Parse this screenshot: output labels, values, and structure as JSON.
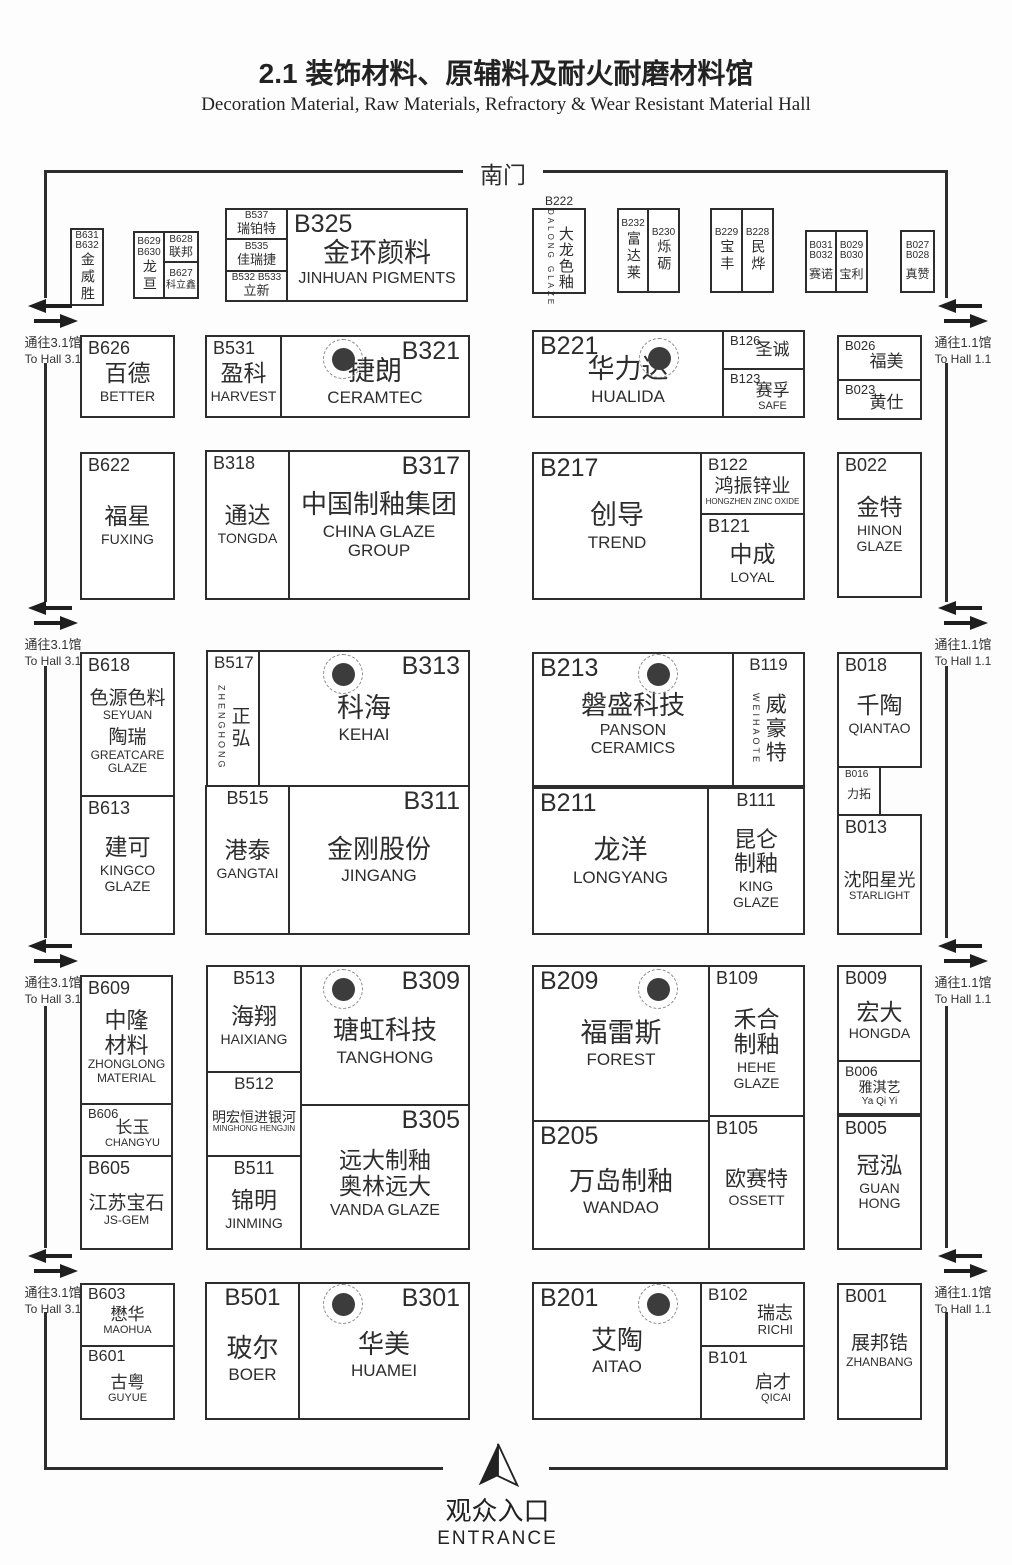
{
  "header": {
    "title_cn": "2.1 装饰材料、原辅料及耐火耐磨材料馆",
    "title_en": "Decoration Material, Raw Materials, Refractory & Wear Resistant Material Hall"
  },
  "gates": {
    "south": "南门"
  },
  "entrance": {
    "cn": "观众入口",
    "en": "ENTRANCE"
  },
  "passages": {
    "left_cn": "通往3.1馆",
    "left_en": "To Hall 3.1",
    "right_cn": "通往1.1馆",
    "right_en": "To Hall 1.1"
  },
  "colors": {
    "line": "#2d2d2d",
    "pillar": "#3c3c3c"
  },
  "booths": {
    "B631": {
      "id": "B631\nB632",
      "cn": "金威胜"
    },
    "B629": {
      "id": "B629\nB630",
      "cn": "龙亘"
    },
    "B628": {
      "id": "B628",
      "cn": "联邦"
    },
    "B627": {
      "id": "B627",
      "cn": "科立鑫"
    },
    "B537": {
      "id": "B537",
      "cn": "瑞铂特"
    },
    "B535": {
      "id": "B535",
      "cn": "佳瑞捷"
    },
    "B532": {
      "id": "B532 B533",
      "cn": "立新"
    },
    "B325": {
      "id": "B325",
      "cn": "金环颜料",
      "en": "JINHUAN PIGMENTS"
    },
    "B222": {
      "id": "B222",
      "cn": "大龙色釉",
      "en": "DALONG GLAZE"
    },
    "B232": {
      "id": "B232",
      "cn": "富达莱"
    },
    "B230": {
      "id": "B230",
      "cn": "烁砺"
    },
    "B229": {
      "id": "B229",
      "cn": "宝丰"
    },
    "B228": {
      "id": "B228",
      "cn": "民烨"
    },
    "B031": {
      "id": "B031\nB032",
      "cn": "赛诺"
    },
    "B029": {
      "id": "B029\nB030",
      "cn": "宝利"
    },
    "B027": {
      "id": "B027\nB028",
      "cn": "真赞"
    },
    "B626": {
      "id": "B626",
      "cn": "百德",
      "en": "BETTER"
    },
    "B531": {
      "id": "B531",
      "cn": "盈科",
      "en": "HARVEST"
    },
    "B321": {
      "id": "B321",
      "cn": "捷朗",
      "en": "CERAMTEC"
    },
    "B221": {
      "id": "B221",
      "cn": "华力达",
      "en": "HUALIDA"
    },
    "B126": {
      "id": "B126",
      "cn": "圣诚"
    },
    "B123": {
      "id": "B123",
      "cn": "赛孚",
      "en": "SAFE"
    },
    "B026": {
      "id": "B026",
      "cn": "福美"
    },
    "B023": {
      "id": "B023",
      "cn": "黄仕"
    },
    "B622": {
      "id": "B622",
      "cn": "福星",
      "en": "FUXING"
    },
    "B318": {
      "id": "B318",
      "cn": "通达",
      "en": "TONGDA"
    },
    "B317": {
      "id": "B317",
      "cn": "中国制釉集团",
      "en": "CHINA GLAZE\nGROUP"
    },
    "B217": {
      "id": "B217",
      "cn": "创导",
      "en": "TREND"
    },
    "B122": {
      "id": "B122",
      "cn": "鸿振锌业",
      "en": "HONGZHEN ZINC OXIDE"
    },
    "B121": {
      "id": "B121",
      "cn": "中成",
      "en": "LOYAL"
    },
    "B022": {
      "id": "B022",
      "cn": "金特",
      "en": "HINON\nGLAZE"
    },
    "B618": {
      "id": "B618",
      "cn": "色源色料",
      "en": "SEYUAN",
      "cn2": "陶瑞",
      "en2": "GREATCARE\nGLAZE"
    },
    "B517": {
      "id": "B517",
      "cn": "正弘",
      "en": "ZHENGHONG"
    },
    "B313": {
      "id": "B313",
      "cn": "科海",
      "en": "KEHAI"
    },
    "B213": {
      "id": "B213",
      "cn": "磐盛科技",
      "en": "PANSON\nCERAMICS"
    },
    "B119": {
      "id": "B119",
      "cn": "威豪特",
      "en": "WEIHAOTE"
    },
    "B018": {
      "id": "B018",
      "cn": "千陶",
      "en": "QIANTAO"
    },
    "B016": {
      "id": "B016",
      "cn": "力拓"
    },
    "B013": {
      "id": "B013",
      "cn": "沈阳星光",
      "en": "STARLIGHT"
    },
    "B613": {
      "id": "B613",
      "cn": "建可",
      "en": "KINGCO\nGLAZE"
    },
    "B515": {
      "id": "B515",
      "cn": "港泰",
      "en": "GANGTAI"
    },
    "B311": {
      "id": "B311",
      "cn": "金刚股份",
      "en": "JINGANG"
    },
    "B211": {
      "id": "B211",
      "cn": "龙洋",
      "en": "LONGYANG"
    },
    "B111": {
      "id": "B111",
      "cn": "昆仑\n制釉",
      "en": "KING\nGLAZE"
    },
    "B609": {
      "id": "B609",
      "cn": "中隆\n材料",
      "en": "ZHONGLONG\nMATERIAL"
    },
    "B606": {
      "id": "B606",
      "cn": "长玉",
      "en": "CHANGYU"
    },
    "B605": {
      "id": "B605",
      "cn": "江苏宝石",
      "en": "JS-GEM"
    },
    "B513": {
      "id": "B513",
      "cn": "海翔",
      "en": "HAIXIANG"
    },
    "B512": {
      "id": "B512",
      "cn": "明宏恒进银河",
      "en": "MINGHONG HENGJIN"
    },
    "B511": {
      "id": "B511",
      "cn": "锦明",
      "en": "JINMING"
    },
    "B309": {
      "id": "B309",
      "cn": "瑭虹科技",
      "en": "TANGHONG"
    },
    "B305": {
      "id": "B305",
      "cn": "远大制釉\n奥林远大",
      "en": "VANDA GLAZE"
    },
    "B209": {
      "id": "B209",
      "cn": "福雷斯",
      "en": "FOREST"
    },
    "B109": {
      "id": "B109",
      "cn": "禾合\n制釉",
      "en": "HEHE\nGLAZE"
    },
    "B205": {
      "id": "B205",
      "cn": "万岛制釉",
      "en": "WANDAO"
    },
    "B105": {
      "id": "B105",
      "cn": "欧赛特",
      "en": "OSSETT"
    },
    "B009": {
      "id": "B009",
      "cn": "宏大",
      "en": "HONGDA"
    },
    "B006": {
      "id": "B006",
      "cn": "雅淇艺",
      "en": "Ya Qi Yi"
    },
    "B005": {
      "id": "B005",
      "cn": "冠泓",
      "en": "GUAN\nHONG"
    },
    "B603": {
      "id": "B603",
      "cn": "懋华",
      "en": "MAOHUA"
    },
    "B601": {
      "id": "B601",
      "cn": "古粤",
      "en": "GUYUE"
    },
    "B501": {
      "id": "B501",
      "cn": "玻尔",
      "en": "BOER"
    },
    "B301": {
      "id": "B301",
      "cn": "华美",
      "en": "HUAMEI"
    },
    "B201": {
      "id": "B201",
      "cn": "艾陶",
      "en": "AITAO"
    },
    "B102": {
      "id": "B102",
      "cn": "瑞志",
      "en": "RICHI"
    },
    "B101": {
      "id": "B101",
      "cn": "启才",
      "en": "QICAI"
    },
    "B001": {
      "id": "B001",
      "cn": "展邦锆",
      "en": "ZHANBANG"
    }
  }
}
